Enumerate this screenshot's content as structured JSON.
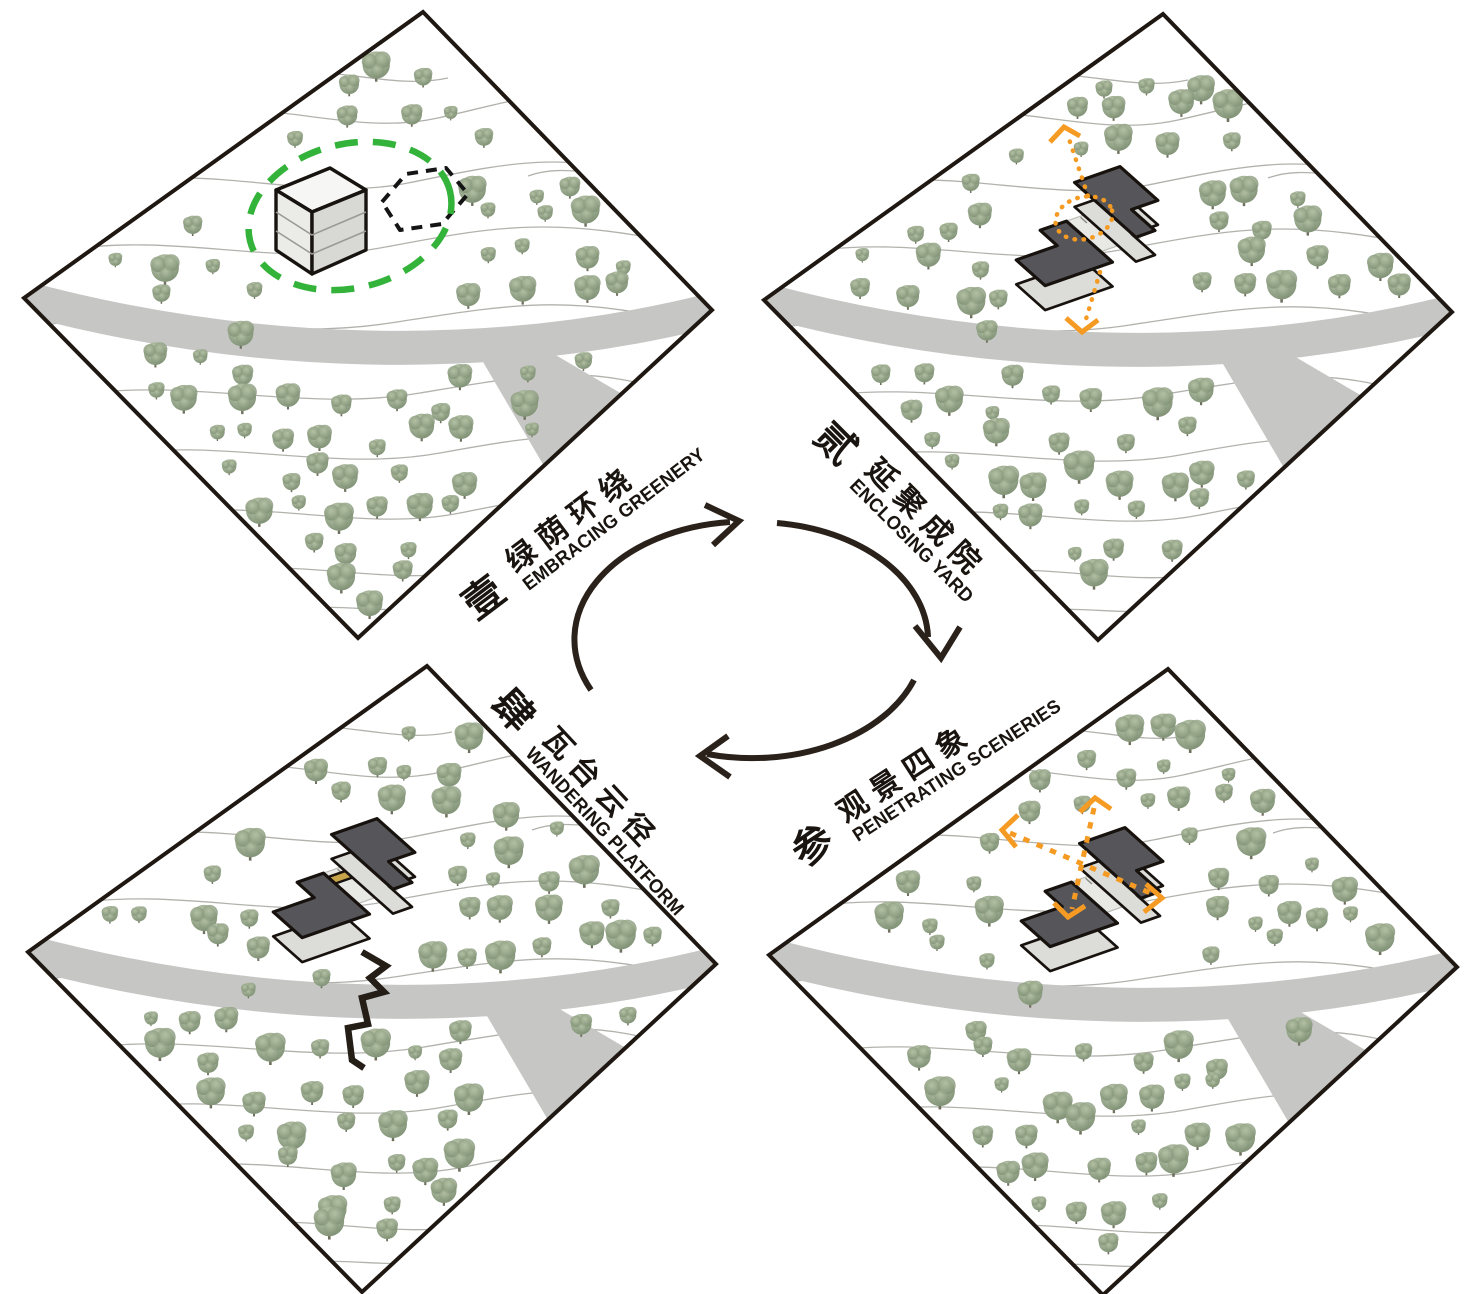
{
  "panels": [
    {
      "id": "embracing-greenery",
      "numeral": "壹",
      "title_zh": "绿荫环绕",
      "title_en": "EMBRACING GREENERY"
    },
    {
      "id": "enclosing-yard",
      "numeral": "贰",
      "title_zh": "延聚成院",
      "title_en": "ENCLOSING YARD"
    },
    {
      "id": "penetrating-sceneries",
      "numeral": "参",
      "title_zh": "观景四象",
      "title_en": "PENETRATING SCENERIES"
    },
    {
      "id": "wandering-platform",
      "numeral": "肆",
      "title_zh": "瓦台云径",
      "title_en": "WANDERING PLATFORM"
    }
  ],
  "cycle": {
    "direction": "clockwise",
    "order": [
      "壹",
      "贰",
      "参",
      "肆"
    ]
  },
  "palette": {
    "ink": "#2a211a",
    "site_border": "#1f1812",
    "road": "#c6c6c4",
    "contour": "#b2b2ad",
    "roof": "#55555a",
    "wall": "#dcdcd8",
    "courtyard": "#e8e8e4",
    "cube_top": "#f6f6f4",
    "cube_left": "#ebebe8",
    "cube_right": "#d8d8d4",
    "highlight_green": "#33b33a",
    "highlight_orange": "#f59b23",
    "gold": "#c7a34a"
  }
}
